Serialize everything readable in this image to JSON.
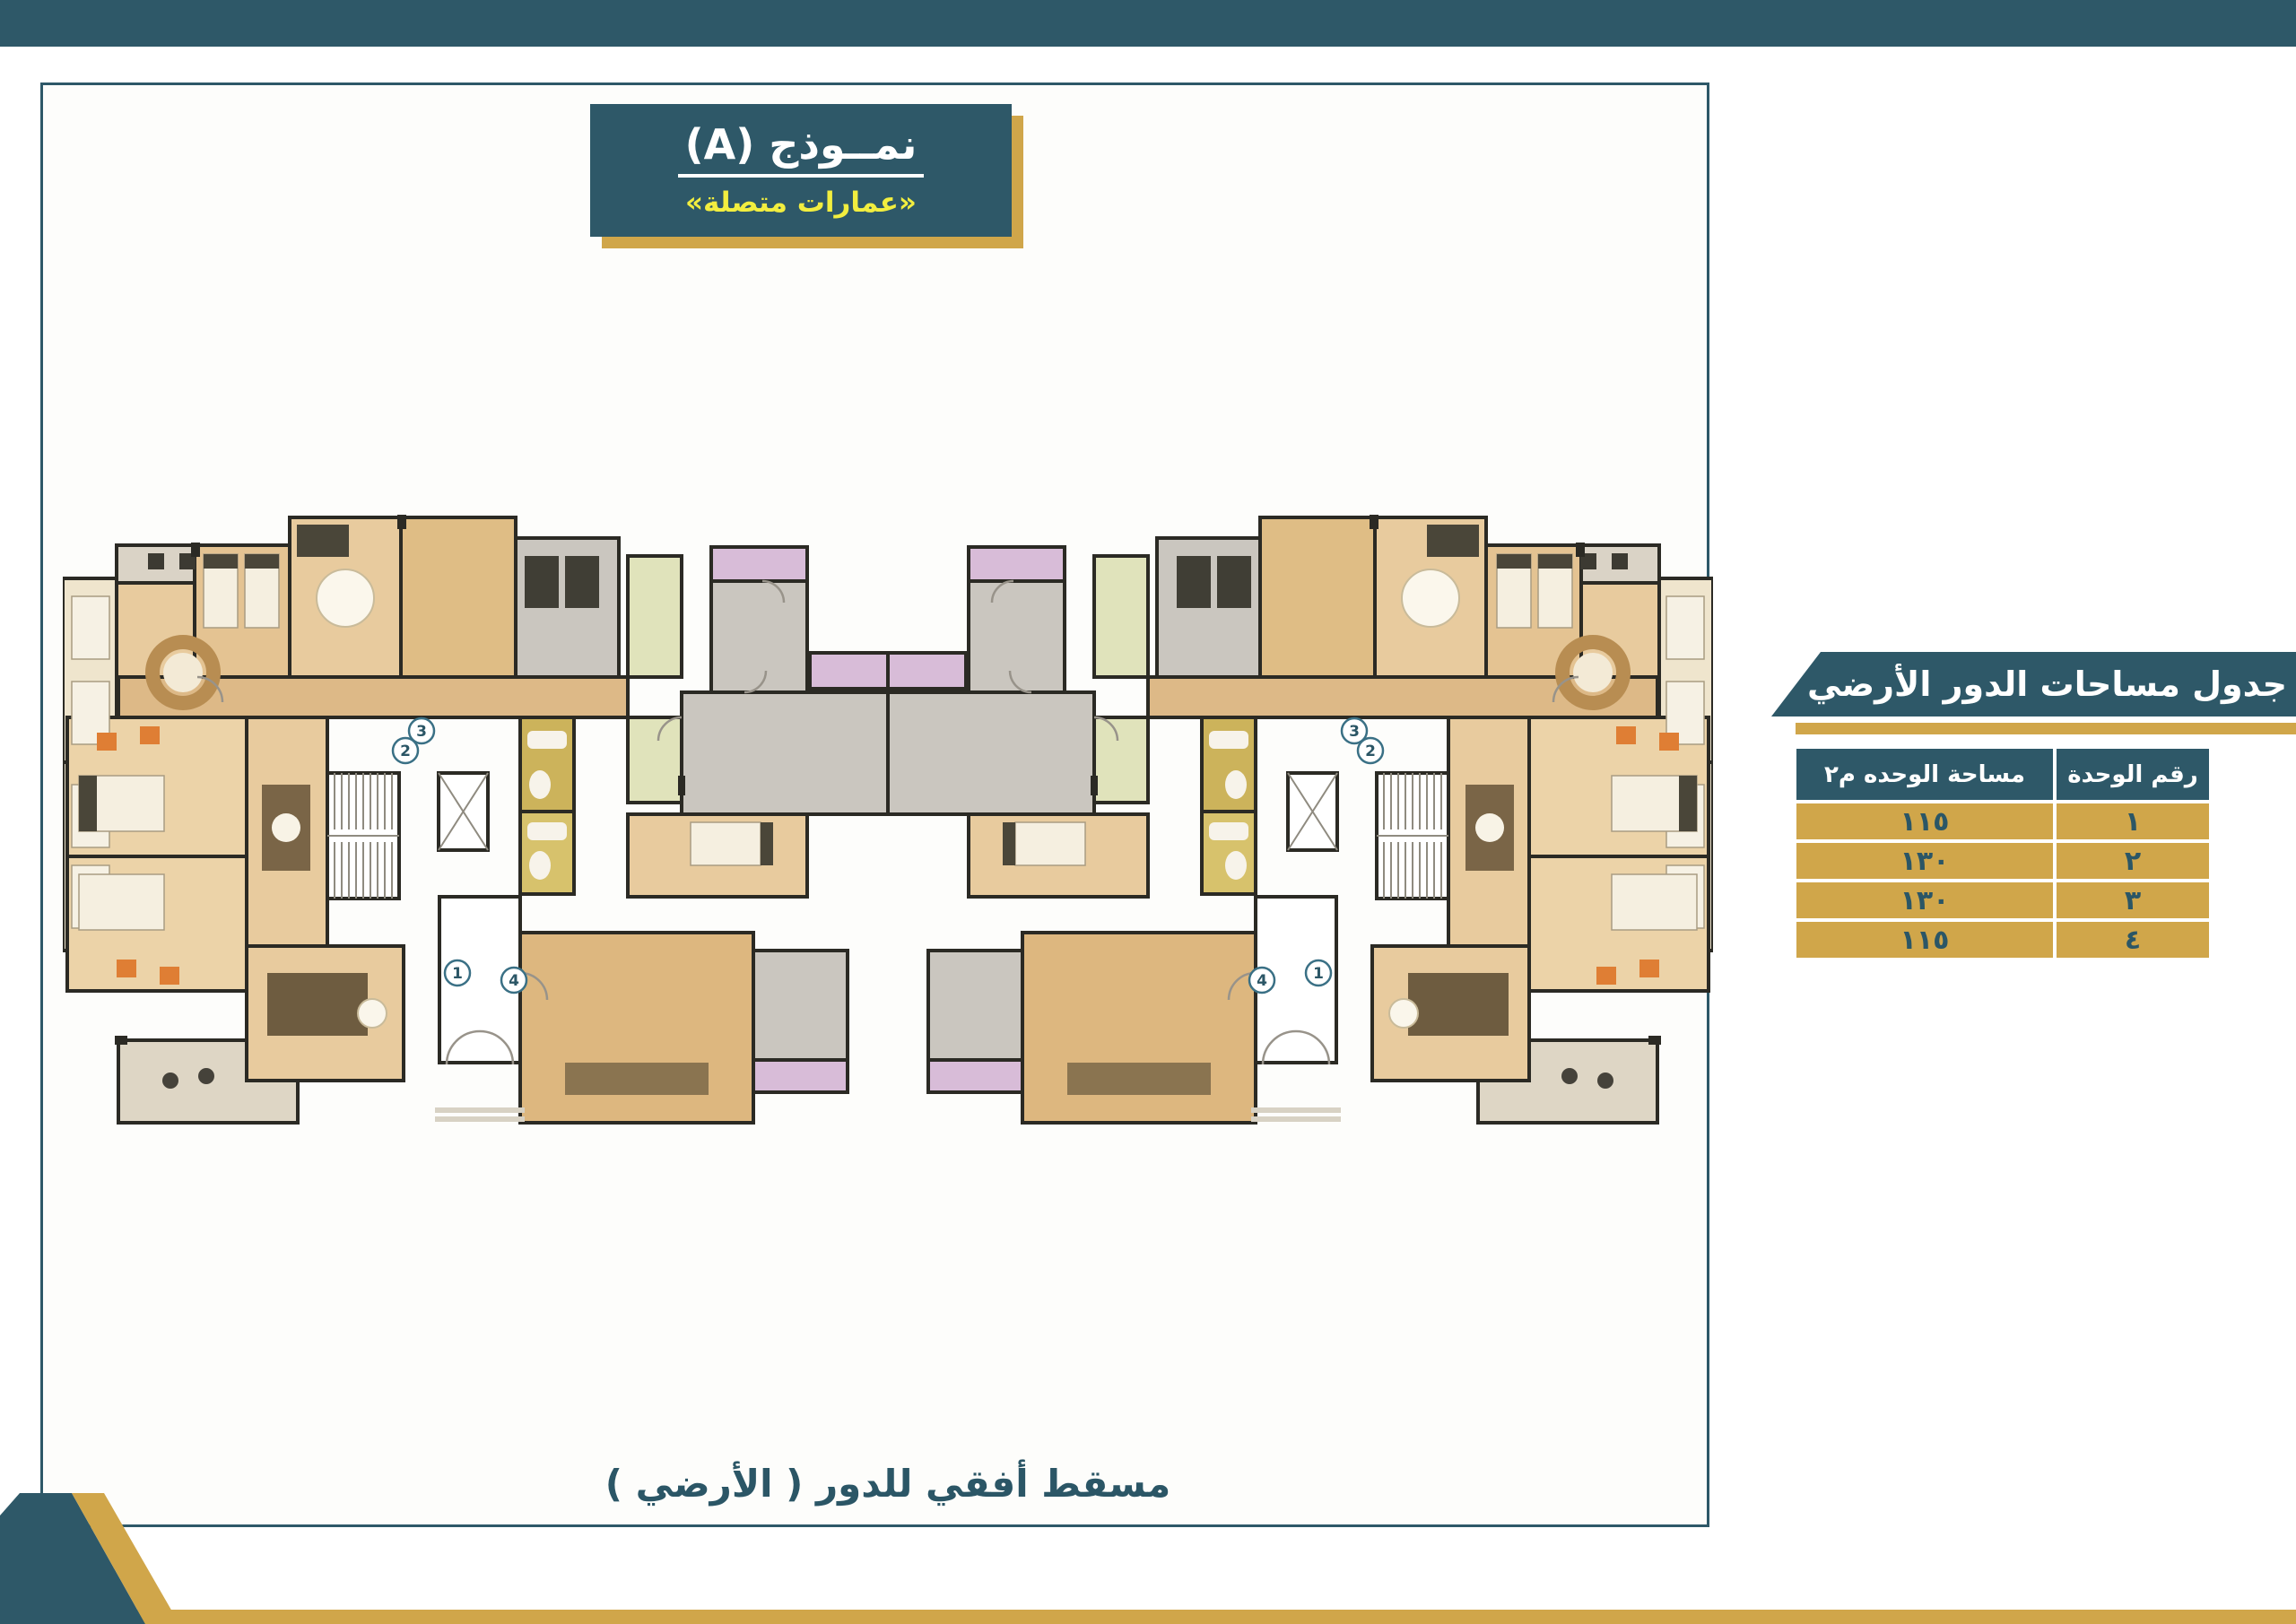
{
  "colors": {
    "teal": "#2e5868",
    "teal_text": "#2b5666",
    "gold": "#d0a64a",
    "yellow": "#f2ee3f",
    "plan_wall": "#2b2a24",
    "plan_tan": "#ddb77f",
    "plan_light_tan": "#e8cb9e",
    "plan_cream": "#efe5cd",
    "plan_gray_room": "#cac6bf",
    "plan_green_room": "#e0e3bb",
    "plan_lavender": "#d8bcd8",
    "plan_olive": "#ccb35b",
    "plan_orange_chair": "#df7e34"
  },
  "badge": {
    "title": "نمــوذج (A)",
    "subtitle": "«عمارات متصلة»"
  },
  "areas_panel": {
    "title": "جدول مساحات الدور الأرضي",
    "table": {
      "headers": {
        "unit_no": "رقم الوحدة",
        "unit_area": "مساحة الوحده م٢"
      },
      "rows": [
        {
          "no": "١",
          "area": "١١٥"
        },
        {
          "no": "٢",
          "area": "١٣٠"
        },
        {
          "no": "٣",
          "area": "١٣٠"
        },
        {
          "no": "٤",
          "area": "١١٥"
        }
      ]
    }
  },
  "plan": {
    "caption": "مسقط أفقي للدور ( الأرضي )",
    "unit_markers": [
      "1",
      "2",
      "3",
      "4"
    ]
  }
}
